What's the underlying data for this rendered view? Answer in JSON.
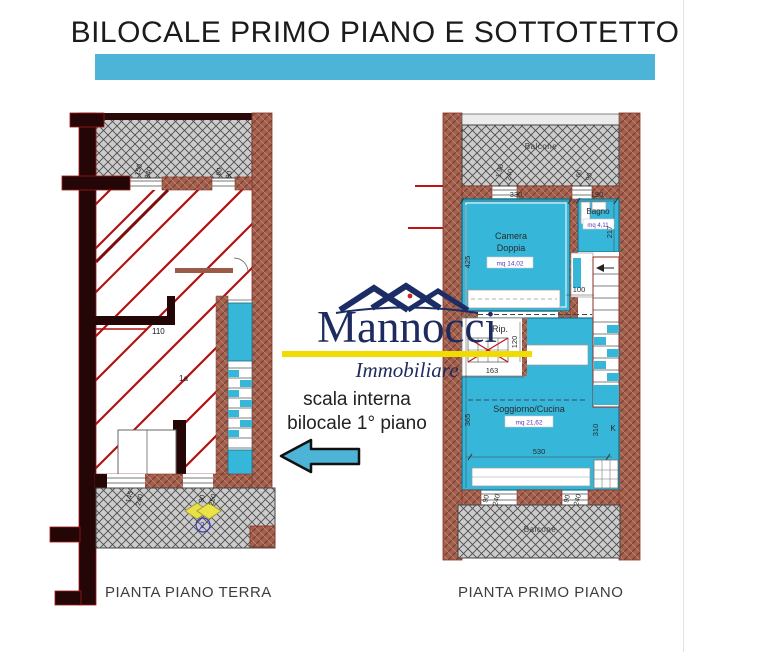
{
  "title": "BILOCALE PRIMO PIANO E SOTTOTETTO",
  "colors": {
    "accent": "#4db4d7",
    "room_fill": "#36b6d9",
    "wall_brick": "#a5604d",
    "dark_wall": "#240607",
    "red_line": "#b21010",
    "hatch_gray": "#cccccc",
    "logo_navy": "#1d2b5f",
    "logo_yellow": "#f0dc00"
  },
  "logo": {
    "name": "Mannocci",
    "subtitle": "Immobiliare"
  },
  "note": {
    "line1": "scala interna",
    "line2": "bilocale 1° piano"
  },
  "captions": {
    "ground_floor": "PIANTA PIANO TERRA",
    "first_floor": "PIANTA PRIMO PIANO"
  },
  "ground_plan": {
    "labels": {
      "room_width": "110",
      "room_tag": "1a",
      "stair_marker": "2"
    },
    "dims": {
      "window_top": [
        "150",
        "240"
      ],
      "window_top_right": [
        "60",
        "90"
      ],
      "door_bottom": [
        "145",
        "240"
      ],
      "door_bottom_right": [
        "90",
        "250"
      ]
    }
  },
  "first_plan": {
    "rooms": {
      "balcone_top": "Balcone",
      "balcone_bottom": "Balcone",
      "camera_line1": "Camera",
      "camera_line2": "Doppia",
      "camera_area": "mq 14,02",
      "bagno": "Bagno",
      "bagno_area": "mq 4,11",
      "soggiorno": "Soggiorno/Cucina",
      "soggiorno_area": "mq 21,62",
      "rip": "Rip.",
      "kitchen_tag": "K"
    },
    "dims": {
      "top_width": "330",
      "top_right_width": "190",
      "camera_height": "425",
      "bagno_height": "217",
      "hall_width": "100",
      "stair_depth": "120",
      "rip_width": "163",
      "soggiorno_height": "365",
      "soggiorno_right_height": "310",
      "bottom_width": "530",
      "window_top": [
        "1.90",
        "240"
      ],
      "window_top_right": [
        "60",
        "90"
      ],
      "window_bottom": [
        "90",
        "240"
      ],
      "window_bottom_right": [
        "90",
        "240"
      ]
    }
  }
}
